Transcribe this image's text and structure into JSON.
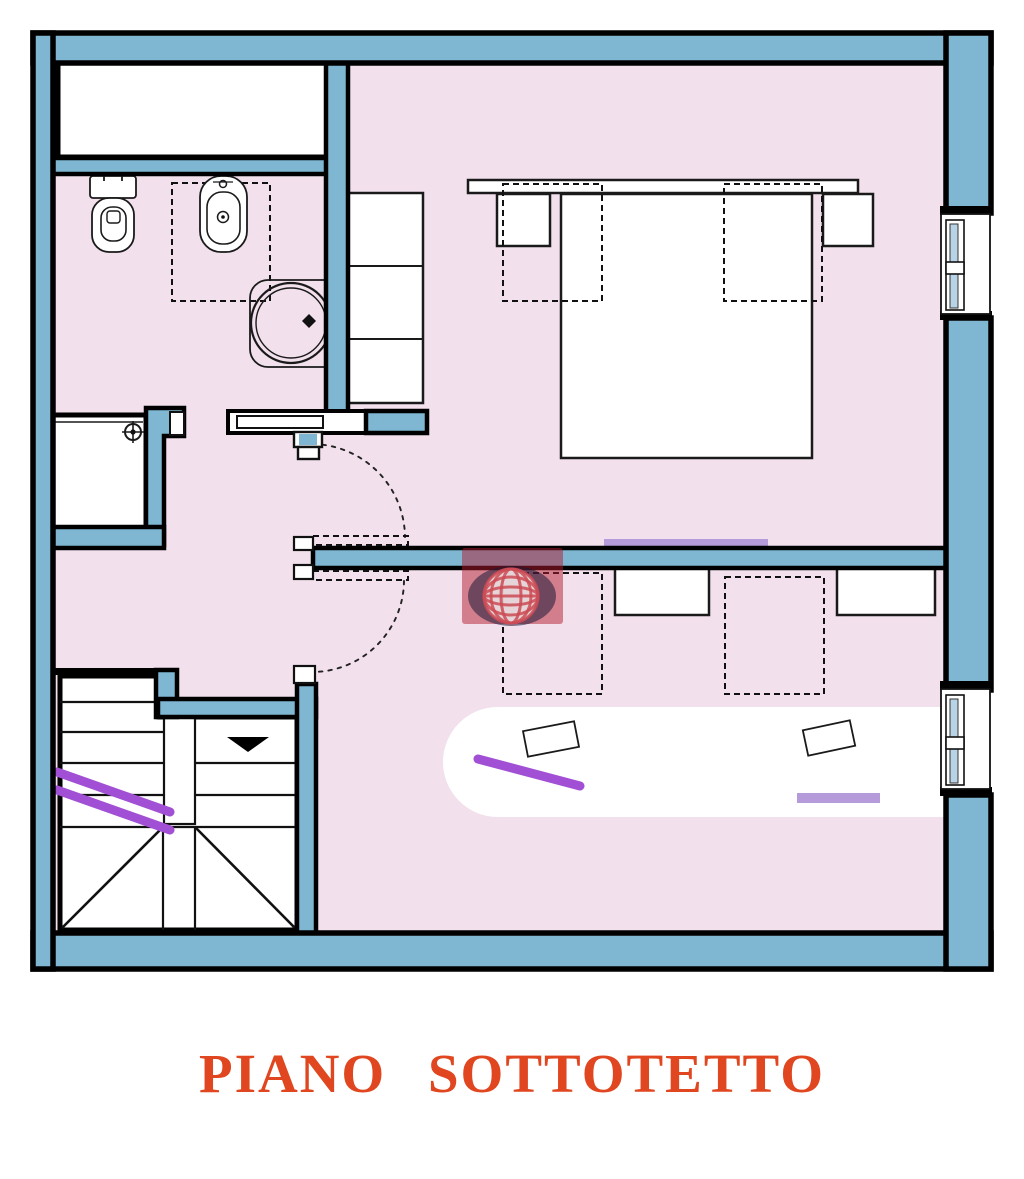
{
  "title": {
    "text": "PIANO SOTTOTETTO",
    "color": "#e0461f"
  },
  "plan": {
    "colors": {
      "floor": "#f2e1ec",
      "wall_fill": "#7fb7d3",
      "wall_stroke": "#000000",
      "glass": "#b9d3e6",
      "accent_lavender": "#b59bd9",
      "handrail_purple": "#a14fd4",
      "watermark_red": "rgba(178,28,45,0.5)",
      "watermark_navy": "rgba(28,26,56,0.55)",
      "watermark_globe_line": "rgba(205,75,85,0.85)"
    },
    "icons": {
      "watermark": "globe-icon",
      "stairs_direction": "down-arrow-icon",
      "shower_drain": "drain-crosshair-icon"
    }
  }
}
